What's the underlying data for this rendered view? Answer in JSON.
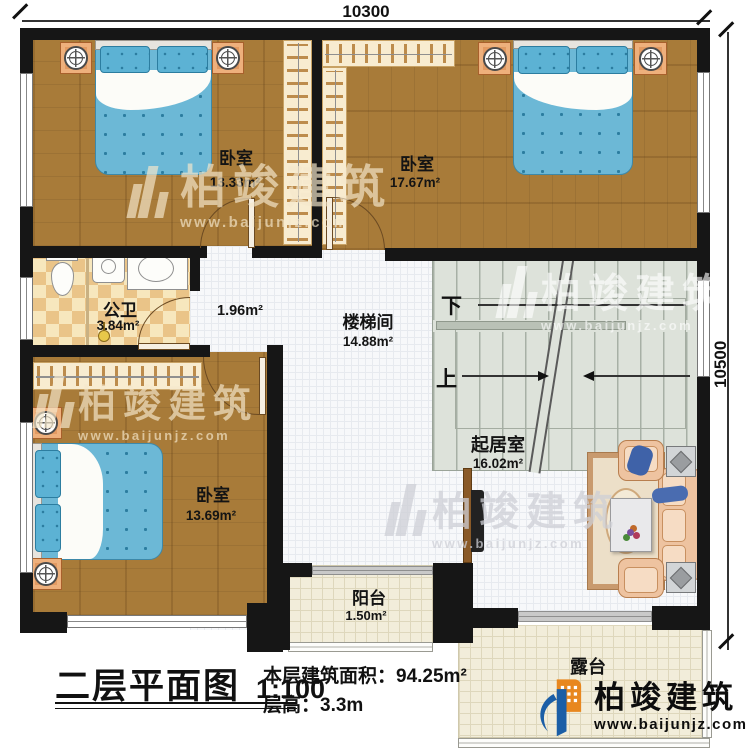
{
  "dimensions": {
    "top": "10300",
    "right": "10500"
  },
  "rooms": {
    "bedroom1": {
      "name": "卧室",
      "area": "13.33m²"
    },
    "bedroom2": {
      "name": "卧室",
      "area": "17.67m²"
    },
    "bedroom3": {
      "name": "卧室",
      "area": "13.69m²"
    },
    "bathroom": {
      "name": "公卫",
      "area": "3.84m²"
    },
    "hall": {
      "area": "1.96m²"
    },
    "stairwell": {
      "name": "楼梯间",
      "area": "14.88m²"
    },
    "living": {
      "name": "起居室",
      "area": "16.02m²"
    },
    "balcony": {
      "name": "阳台",
      "area": "1.50m²"
    },
    "terrace": {
      "name": "露台"
    }
  },
  "stairs": {
    "down_label": "下",
    "up_label": "上"
  },
  "titleblock": {
    "title": "二层平面图",
    "scale": "1:100",
    "area_note": "本层建筑面积：94.25m²",
    "height_note": "层高：3.3m"
  },
  "brand": {
    "name": "柏竣建筑",
    "url": "www.baijunjz.com"
  },
  "colors": {
    "wall": "#161616",
    "wood_floor": "#a87b39",
    "tile_floor": "#f2edda",
    "stair_floor": "#dde2da",
    "bed_blue": "#6cb8d6",
    "brand_orange": "#e8871f",
    "brand_blue": "#1b5ea6"
  }
}
